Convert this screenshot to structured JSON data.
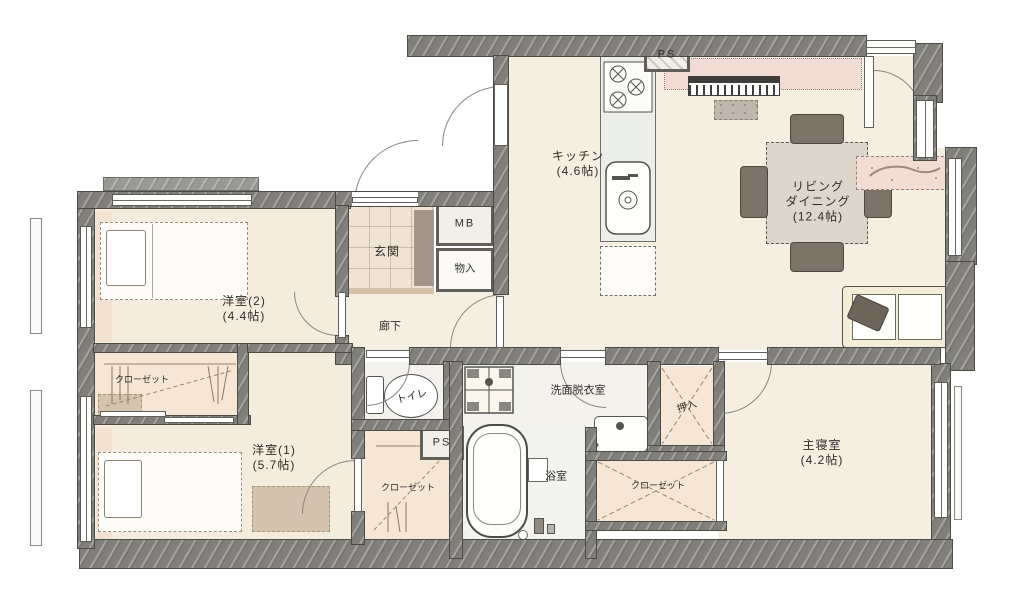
{
  "floor_plan": {
    "rooms": {
      "kitchen": {
        "name": "キッチン",
        "size": "(4.6帖)"
      },
      "living_dining": {
        "name_line1": "リビング",
        "name_line2": "ダイニング",
        "size": "(12.4帖)"
      },
      "bedroom2": {
        "name": "洋室(2)",
        "size": "(4.4帖)"
      },
      "bedroom1": {
        "name": "洋室(1)",
        "size": "(5.7帖)"
      },
      "master_bedroom": {
        "name": "主寝室",
        "size": "(4.2帖)"
      },
      "entrance": {
        "name": "玄関"
      },
      "corridor": {
        "name": "廊下"
      },
      "toilet": {
        "name": "トイレ"
      },
      "washroom": {
        "name": "洗面脱衣室"
      },
      "bathroom": {
        "name": "浴室"
      }
    },
    "storage": {
      "meter_box": "MB",
      "storage_closet": "物入",
      "oshiire": "押入",
      "closet_bedroom2": "クローゼット",
      "closet_bedroom1": "クローゼット",
      "closet_master": "クローゼット",
      "pipe_space_top": "PS",
      "pipe_space_mid": "PS"
    },
    "colors": {
      "wall": "#817f79",
      "floor_wood": "#f5efe2",
      "floor_closet": "#f5e6d6",
      "floor_bath": "#f2f3ee",
      "accent_pink": "#f0dcd4",
      "furniture_dark": "#7d7268"
    }
  }
}
